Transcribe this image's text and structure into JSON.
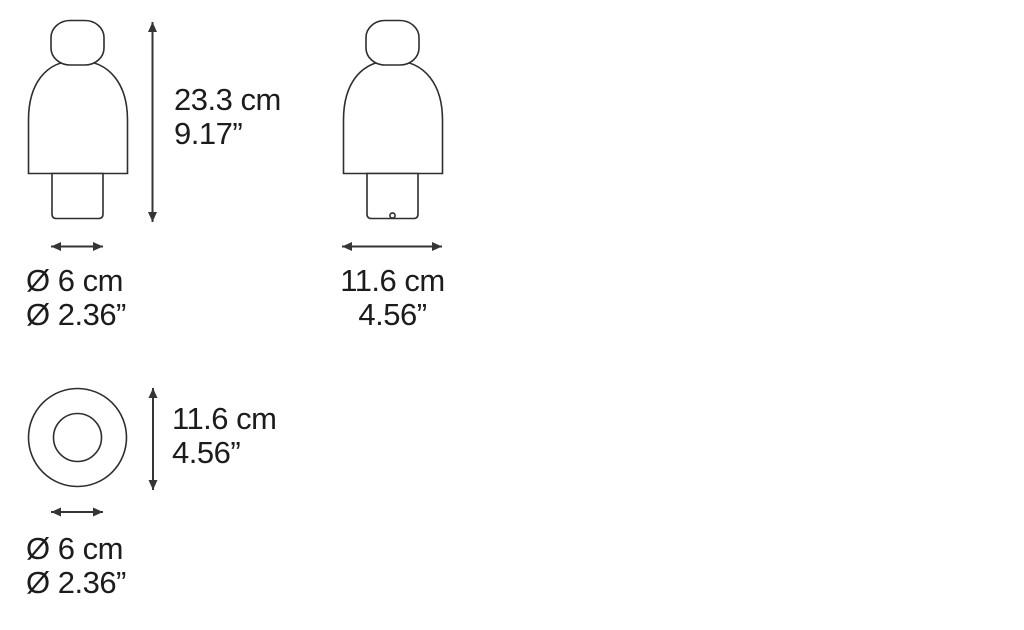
{
  "colors": {
    "background": "#ffffff",
    "line": "#2e2e2e",
    "arrow": "#353535",
    "text": "#1c1c1c"
  },
  "labels": {
    "front_height": {
      "cm": "23.3 cm",
      "in": "9.17”"
    },
    "front_base_diameter": {
      "cm": "Ø 6 cm",
      "in": "Ø 2.36”"
    },
    "side_width": {
      "cm": "11.6 cm",
      "in": "4.56”"
    },
    "top_view_height": {
      "cm": "11.6 cm",
      "in": "4.56”"
    },
    "top_view_inner_diameter": {
      "cm": "Ø 6 cm",
      "in": "Ø 2.36”"
    }
  }
}
